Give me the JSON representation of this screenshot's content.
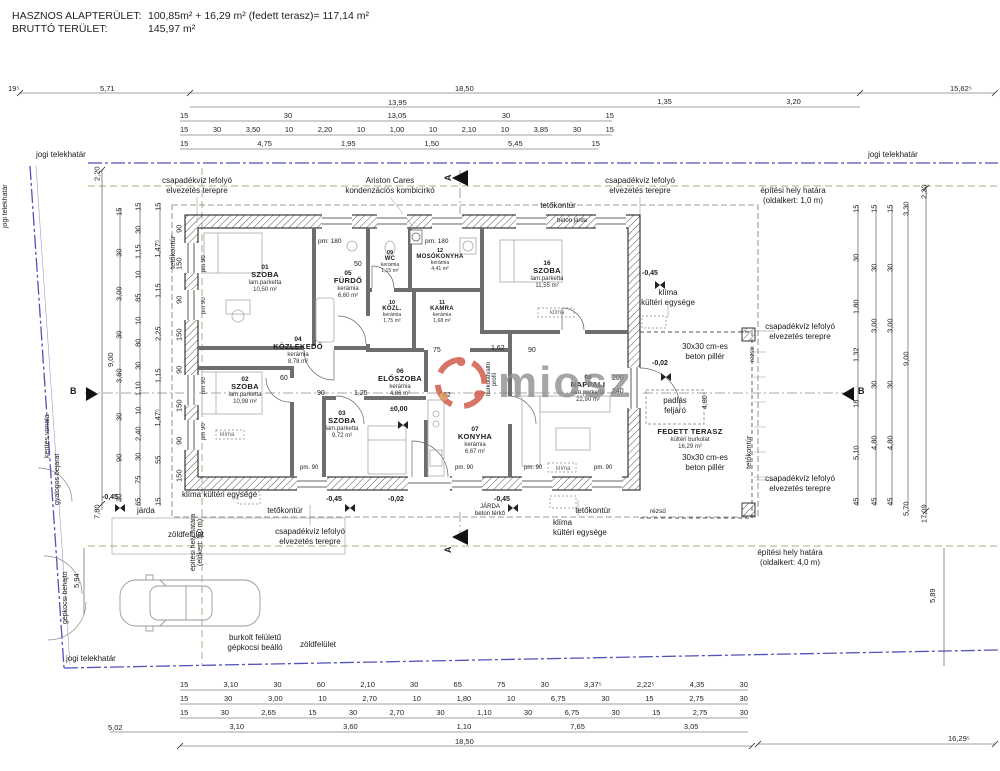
{
  "header": {
    "line1_label": "HASZNOS ALAPTERÜLET:",
    "line1_value": "100,85m² + 16,29 m² (fedett terasz)= 117,14 m²",
    "line2_label": "BRUTTÓ TERÜLET:",
    "line2_value": "145,97 m²"
  },
  "watermark": {
    "text": "miosz",
    "text_color": "#8f8f8f",
    "logo_color": "#cc5240"
  },
  "rooms": [
    {
      "num": "01",
      "name": "SZOBA",
      "material": "lam.parketta",
      "area": "10,50 m²"
    },
    {
      "num": "02",
      "name": "SZOBA",
      "material": "lam.parketta",
      "area": "10,98 m²"
    },
    {
      "num": "03",
      "name": "SZOBA",
      "material": "lam.parketta",
      "area": "9,72 m²"
    },
    {
      "num": "04",
      "name": "KÖZLEKEDŐ",
      "material": "kerámia",
      "area": "8,78 m²"
    },
    {
      "num": "05",
      "name": "FÜRDŐ",
      "material": "kerámia",
      "area": "6,60 m²"
    },
    {
      "num": "06",
      "name": "ELŐSZOBA",
      "material": "kerámia",
      "area": "4,86 m²"
    },
    {
      "num": "07",
      "name": "KONYHA",
      "material": "kerámia",
      "area": "6,67 m²"
    },
    {
      "num": "08",
      "name": "NAPPALI",
      "material": "lam.parketta",
      "area": "22,90 m²"
    },
    {
      "num": "09",
      "name": "WC",
      "material": "kerámia",
      "area": "1,15 m²"
    },
    {
      "num": "10",
      "name": "KÖZL.",
      "material": "kerámia",
      "area": "1,75 m²"
    },
    {
      "num": "11",
      "name": "KAMRA",
      "material": "kerámia",
      "area": "1,68 m²"
    },
    {
      "num": "12",
      "name": "MOSÓKONYHA",
      "material": "kerámia",
      "area": "4,41 m²"
    },
    {
      "num": "16",
      "name": "SZOBA",
      "material": "lam.parketta",
      "area": "11,55 m²"
    },
    {
      "num": "",
      "name": "FEDETT TERASZ",
      "material": "kültéri burkolat",
      "area": "16,29 m²"
    }
  ],
  "ann": {
    "csapadek": "csapadékvíz lefolyó\nelvezetés terepre",
    "ariston": "Ariston Cares\nkondenzációs kombicirkó",
    "hely_old1": "építési hely határa\n(oldalkert: 1,0 m)",
    "hely_old4": "építési hely határa\n(oldalkert: 4,0 m)",
    "hely_elo5": "építési hely határa\n(előkert: 5,0 m)",
    "tetokontur": "tetőkontúr",
    "beton_jarda": "beton járda",
    "jarda": "járda",
    "jarda_terko": "JÁRDA\nbeton térkő",
    "klima_kulteri2": "klíma\nkültéri egysége",
    "klima_kulteri1": "klíma kültéri egysége",
    "klima": "klíma",
    "pillar": "30x30 cm-es\nbeton pillér",
    "padlas": "padlás\nfeljáró",
    "rezsu": "rézsű",
    "zold": "zöldfelület",
    "burkolt": "burkolt felületű\ngépkocsi beálló",
    "jogi": "jogi telekhatár",
    "kerites": "kerítés vonala",
    "gyalogos": "gyalogos bejárat",
    "gepkocsi": "gépkocsi behajtó",
    "burkolatvalto": "burkolatváltó\nprofil",
    "pm180": "pm: 180",
    "pm90dot": "pm. 90",
    "pm90": "pm 90"
  },
  "levels": {
    "zero": "±0,00",
    "m002": "-0,02",
    "m045": "-0,45"
  },
  "markers": {
    "a": "A",
    "b": "B"
  },
  "dims": {
    "topA1": "19⁵",
    "topA2": "5,71",
    "topA3": "18,50",
    "topA4": "15,62⁵",
    "topB1": "13,95",
    "topB2": [
      "1,35",
      "3,20"
    ],
    "topC": [
      "15",
      "30",
      "13,05",
      "30",
      "15"
    ],
    "topD": [
      "15",
      "30",
      "3,50",
      "10",
      "2,20",
      "10",
      "1,00",
      "10",
      "2,10",
      "10",
      "3,85",
      "30",
      "15"
    ],
    "topE": [
      "15",
      "4,75",
      "1,95",
      "1,50",
      "5,45",
      "15"
    ],
    "botA": [
      "15",
      "3,10",
      "30",
      "60",
      "2,10",
      "30",
      "65",
      "75",
      "30",
      "3,37⁵",
      "2,22⁵",
      "4,35",
      "30"
    ],
    "botB": [
      "15",
      "30",
      "3,00",
      "10",
      "2,70",
      "10",
      "1,80",
      "10",
      "6,75",
      "30",
      "15",
      "2,75",
      "30"
    ],
    "botC": [
      "15",
      "30",
      "2,65",
      "15",
      "30",
      "2,70",
      "30",
      "1,10",
      "30",
      "6,75",
      "30",
      "15",
      "2,75",
      "30"
    ],
    "botD1": "5,02",
    "botD2": [
      "3,10",
      "3,60",
      "1,10",
      "7,65",
      "3,05"
    ],
    "botE1": "18,50",
    "botE2": "16,29⁵",
    "left1": [
      "2,20",
      "7,80"
    ],
    "left900": "9,00",
    "left2": [
      "15",
      "30",
      "3,00",
      "30",
      "3,60",
      "30",
      "90",
      "30"
    ],
    "left3": [
      "15",
      "30",
      "1,15",
      "10",
      "85",
      "10",
      "80",
      "30",
      "1,10",
      "10",
      "2,40",
      "30",
      "75",
      "65"
    ],
    "left4": [
      "15",
      "1,47⁵",
      "1,15",
      "2,25",
      "1,15",
      "1,47⁵",
      "55",
      "15"
    ],
    "leftWin": [
      "90",
      "150",
      "90",
      "150",
      "90",
      "150",
      "90",
      "150"
    ],
    "left594": "5,94",
    "right1": [
      "15",
      "30",
      "1,80",
      "1,32",
      "18",
      "5,10",
      "45"
    ],
    "right2": [
      "15",
      "30",
      "3,00",
      "30",
      "4,80",
      "45"
    ],
    "right3": [
      "15",
      "30",
      "3,00",
      "30",
      "4,80",
      "45"
    ],
    "right4": [
      "3,30",
      "9,00",
      "5,70"
    ],
    "right5": [
      "2,20",
      "17,09"
    ],
    "right589": "5,89",
    "inner": {
      "i50": "50",
      "i75": "75",
      "i162": "1,62",
      "i90": "90",
      "i62": "62",
      "i60": "60",
      "i125": "1,25",
      "i200": "200",
      "i240": "240",
      "i480": "4,80"
    }
  }
}
